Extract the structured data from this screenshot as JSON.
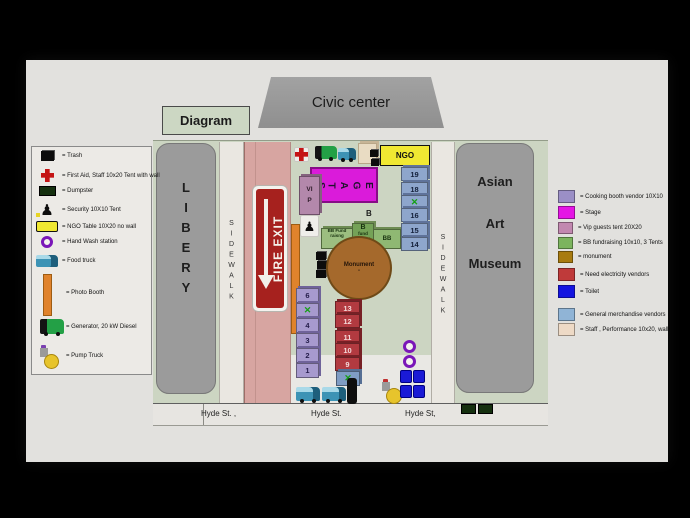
{
  "page": {
    "diagram_label": "Diagram",
    "civic_center_label": "Civic center"
  },
  "buildings": {
    "library_label": "LIBERY",
    "museum_lines": [
      "Asian",
      "Art",
      "Museum"
    ]
  },
  "sidewalk_label": "SIDEWALK",
  "fire_exit_label": "FIRE EXIT",
  "street_labels": [
    "Hyde St. ,",
    "Hyde St.",
    "Hyde St,"
  ],
  "icons": {
    "security_glyph": "♟"
  },
  "map": {
    "ngo_label": "NGO",
    "stage_letters": [
      "S",
      "T",
      "A",
      "G",
      "E"
    ],
    "vip_label": "VIP",
    "b_label": "B",
    "bb_tents": {
      "left": "BB Fund raisng",
      "mid_top": "B",
      "mid_rest": "fund raising",
      "right": "BB"
    },
    "monument_label": "Monument",
    "monument_dash": "-",
    "merch_column": [
      "19",
      "18",
      "✕",
      "16",
      "15",
      "14"
    ],
    "cooking_column": [
      "6",
      "✕",
      "4",
      "3",
      "2",
      "1"
    ],
    "electric_column": [
      "13",
      "12",
      "11",
      "10",
      "9"
    ],
    "crossed_box": "✕"
  },
  "legend_left": {
    "items": [
      {
        "icon": "trash-icon",
        "label": "= Trash"
      },
      {
        "icon": "first-aid-icon",
        "label": "= First Aid, Staff 10x20 Tent with wall"
      },
      {
        "icon": "dumpster-icon",
        "label": "= Dumpster"
      },
      {
        "icon": "security-icon",
        "label": "=  Security 10X10 Tent"
      },
      {
        "icon": "ngo-table-icon",
        "label": "= NGO Table 10X20 no wall"
      },
      {
        "icon": "hand-wash-icon",
        "label": "= Hand Wash  station"
      },
      {
        "icon": "food-truck-icon",
        "label": "= Food truck"
      },
      {
        "icon": "photo-booth-icon",
        "label": "= Photo Booth"
      },
      {
        "icon": "generator-icon",
        "label": "= Generator, 20 kW Diesel"
      },
      {
        "icon": "pump-truck-icon",
        "label": "= Pump Truck"
      }
    ]
  },
  "legend_right": {
    "items": [
      {
        "color": "#9b8fc6",
        "label": "= Cooking booth vendor 10X10"
      },
      {
        "color": "#e515e5",
        "label": "= Stage"
      },
      {
        "color": "#c288b0",
        "label": "= Vip guests tent 20X20"
      },
      {
        "color": "#7cb45e",
        "label": "= BB fundraising 10x10, 3 Tents"
      },
      {
        "color": "#a87b10",
        "label": "= monument"
      },
      {
        "color": "#bf3a3a",
        "label": "= Need electricity vendors"
      },
      {
        "color": "#1414e0",
        "label": "= Toilet"
      },
      {
        "color": "#90b4d6",
        "label": "= General merchandise vendors"
      },
      {
        "color": "#eedac6",
        "label": "= Staff , Performance 10x20, wall"
      }
    ]
  }
}
